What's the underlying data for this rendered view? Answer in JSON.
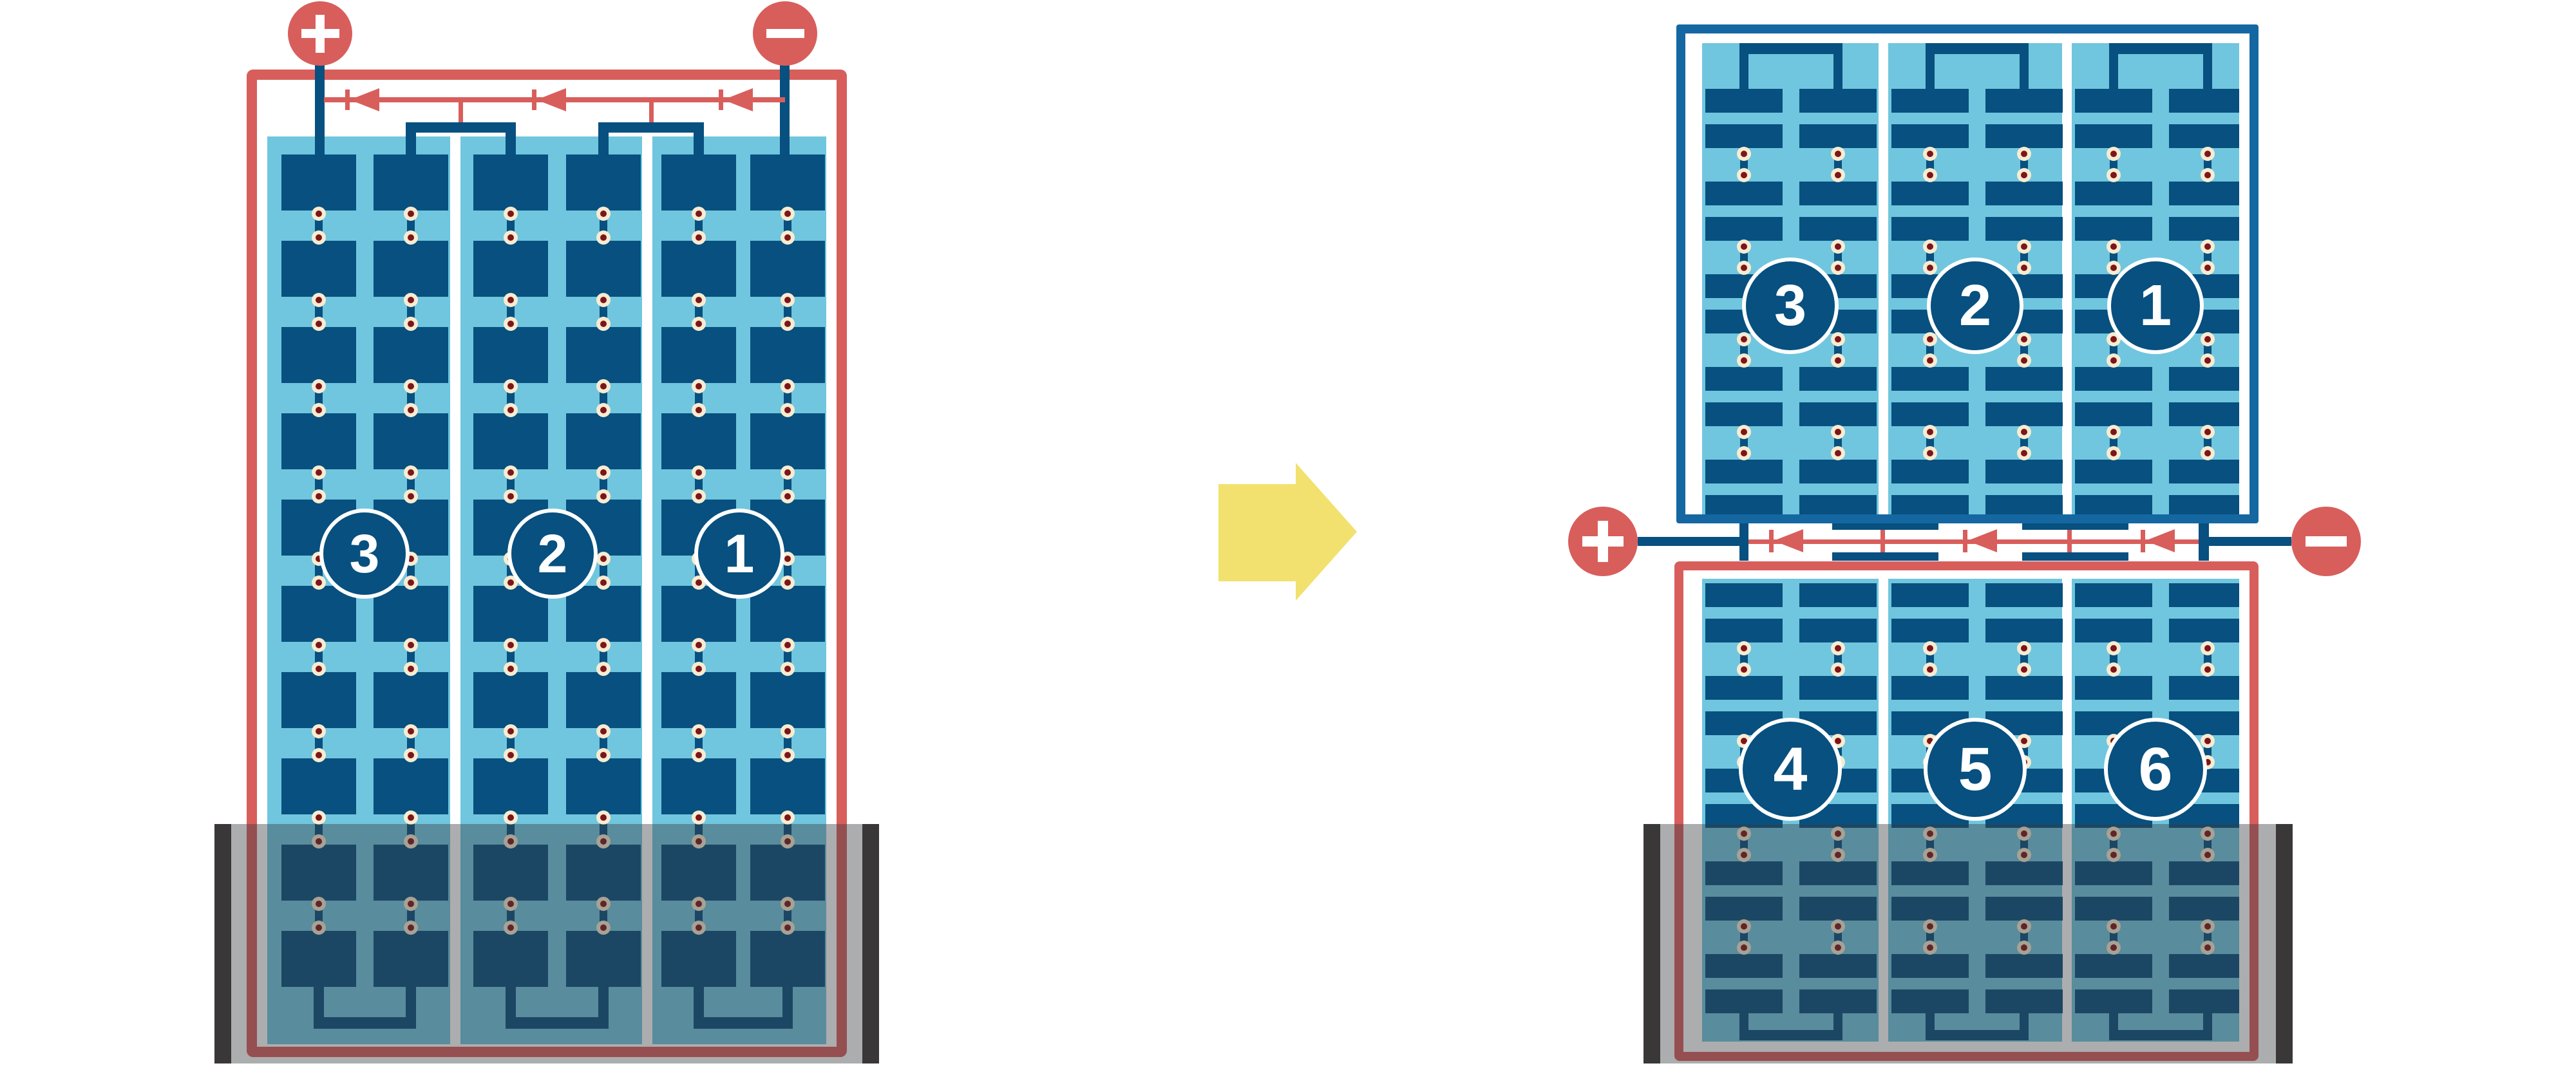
{
  "colors": {
    "accent_red": "#d85e5c",
    "cell_navy": "#07507f",
    "top_frame_blue": "#1567a2",
    "panel_light_blue": "#70c6de",
    "solder_dot_cream": "#f7ecd2",
    "solder_dot_maroon": "#7e1518",
    "arrow_yellow": "#f2e16e",
    "water_overlay": "rgba(58,60,64,0.42)",
    "overlay_end_bar": "#3a3739"
  },
  "left_module": {
    "terminals": {
      "positive_label": "+",
      "negative_label": "−"
    },
    "string_badges": [
      "3",
      "2",
      "1"
    ],
    "bypass_diode_count": 3
  },
  "right_module": {
    "terminals": {
      "positive_label": "+",
      "negative_label": "−"
    },
    "top_string_badges": [
      "3",
      "2",
      "1"
    ],
    "bottom_string_badges": [
      "4",
      "5",
      "6"
    ],
    "bypass_diode_count": 3
  },
  "arrow": {
    "direction": "right"
  }
}
